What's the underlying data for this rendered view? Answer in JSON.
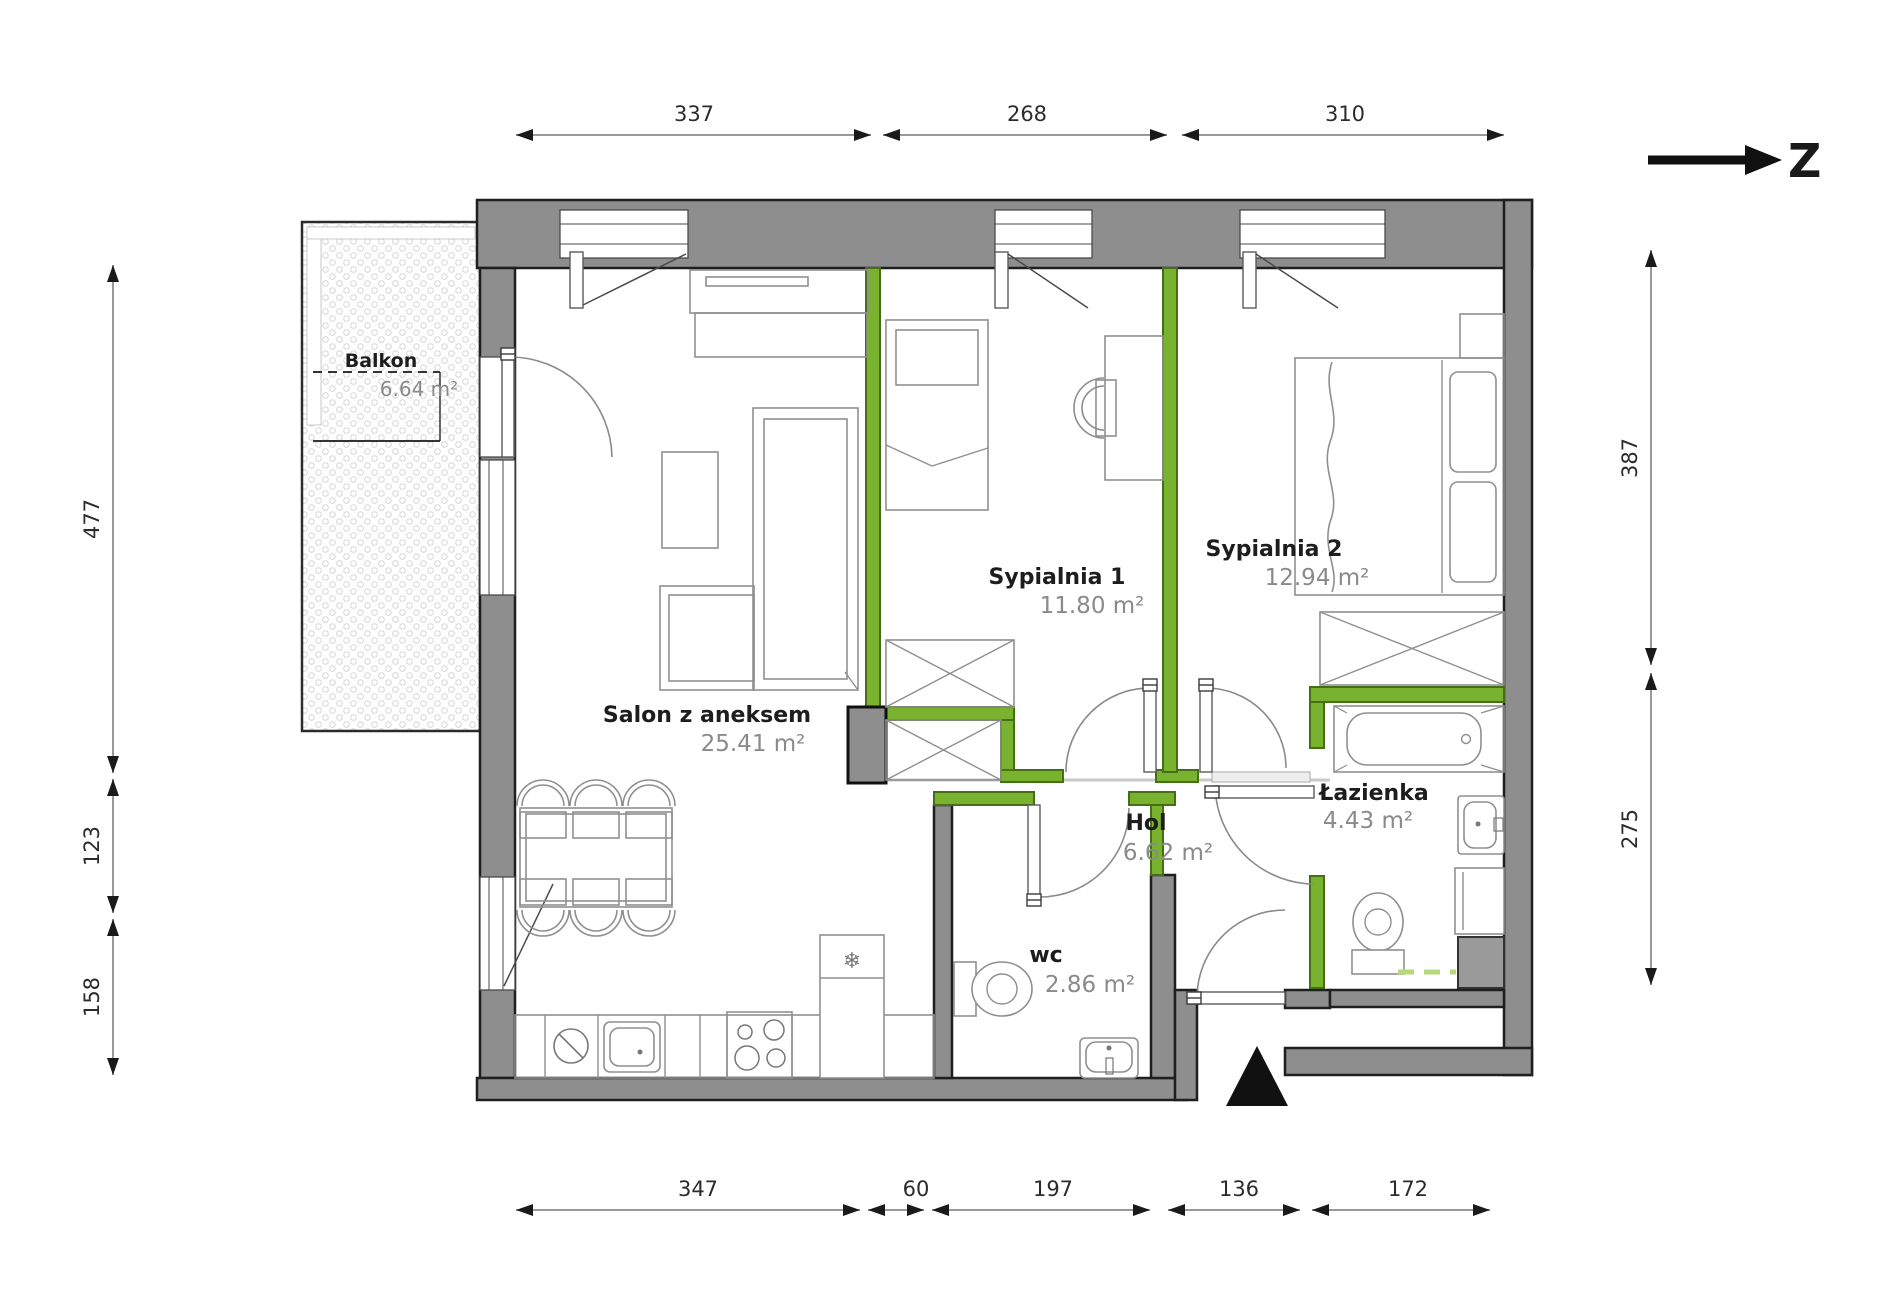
{
  "north_indicator": {
    "label": "Z"
  },
  "rooms": [
    {
      "name": "Balkon",
      "area": "6.64 m²"
    },
    {
      "name": "Salon z aneksem",
      "area": "25.41 m²"
    },
    {
      "name": "Sypialnia 1",
      "area": "11.80 m²"
    },
    {
      "name": "Sypialnia 2",
      "area": "12.94 m²"
    },
    {
      "name": "Hol",
      "area": "6.62 m²"
    },
    {
      "name": "wc",
      "area": "2.86 m²"
    },
    {
      "name": "Łazienka",
      "area": "4.43 m²"
    }
  ],
  "dimensions": {
    "top": [
      "337",
      "268",
      "310"
    ],
    "bottom": [
      "347",
      "60",
      "197",
      "136",
      "172"
    ],
    "left": [
      "477",
      "123",
      "158"
    ],
    "right": [
      "387",
      "275"
    ]
  },
  "colors": {
    "accent_green": "#79b22e",
    "wall_gray": "#8e8e8e",
    "dashed_green": "#b6d97d"
  }
}
